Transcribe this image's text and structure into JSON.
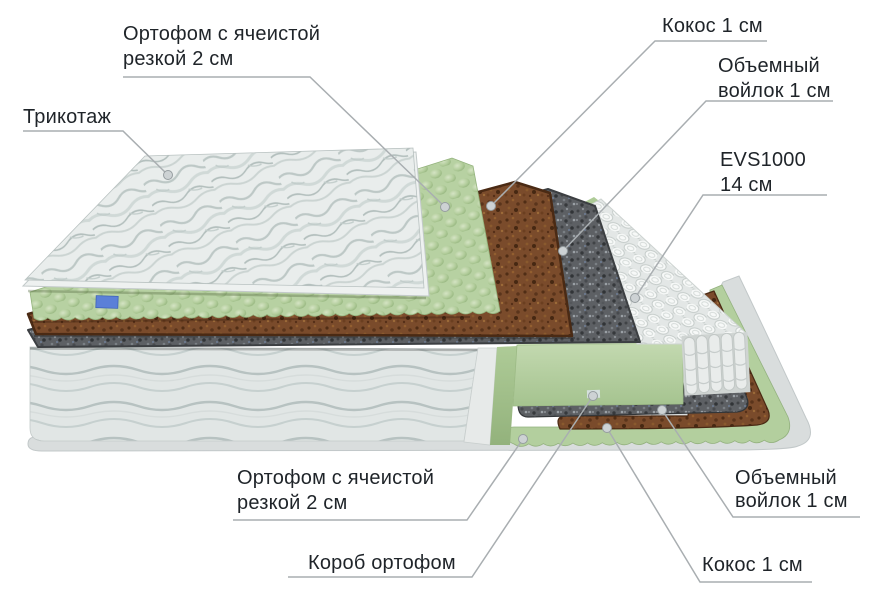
{
  "figure": {
    "type": "mattress-layers-cutaway-diagram",
    "background": "#ffffff",
    "text_color": "#1f2429",
    "leader_line_color": "#a9aeb1",
    "labels": {
      "orthofoam_top": {
        "line1": "Ортофом с ячеистой",
        "line2": "резкой 2 см"
      },
      "tricot": {
        "line1": "Трикотаж"
      },
      "coco_top": {
        "line1": "Кокос 1 см"
      },
      "felt_top": {
        "line1": "Объемный",
        "line2": "войлок 1 см"
      },
      "evs": {
        "line1": "EVS1000",
        "line2": "14 см"
      },
      "orthofoam_bottom": {
        "line1": "Ортофом с ячеистой",
        "line2": "резкой 2 см"
      },
      "box": {
        "line1": "Короб ортофом"
      },
      "felt_bottom": {
        "line1": "Объемный",
        "line2": "войлок 1 см"
      },
      "coco_bottom": {
        "line1": "Кокос 1 см"
      }
    },
    "materials": {
      "quilt_top": "#e9edec",
      "quilt_side": "#e1e6e5",
      "foam_green": "#b7d1a2",
      "coconut_brown": "#7a4b2b",
      "felt_grey": "#5d6064",
      "springs_white": "#eef1f0",
      "box_green": "#b6d1a2",
      "base_border": "#d9dddd",
      "brand_tag_blue": "#5b80d8"
    }
  }
}
